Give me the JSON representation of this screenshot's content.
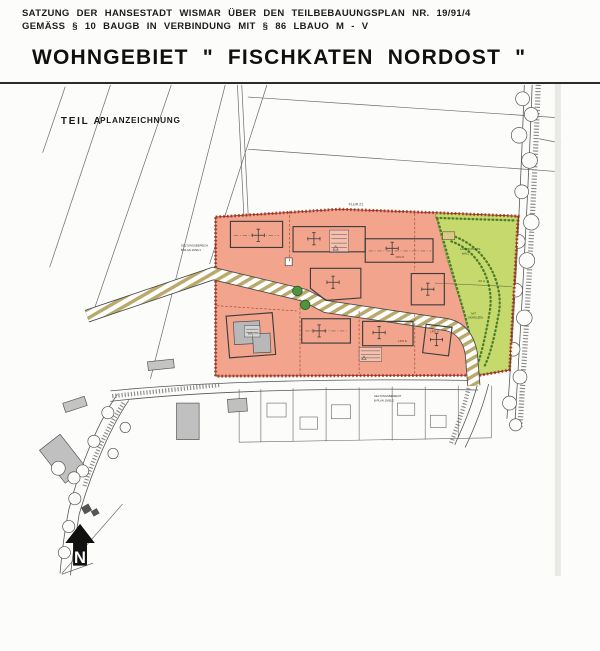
{
  "header": {
    "line1": "SATZUNG DER HANSESTADT WISMAR ÜBER DEN TEILBEBAUUNGSPLAN NR. 19/91/4",
    "line2": "GEMÄSS § 10 BAUGB IN VERBINDUNG MIT § 86 LBAUO M - V",
    "title": "WOHNGEBIET \" FISCHKATEN  NORDOST \""
  },
  "map": {
    "section": {
      "part": "TEIL A",
      "name": "PLANZEICHNUNG"
    },
    "labels": {
      "flur": "FLUR 21",
      "scope_west_line1": "GELTUNGSBEREICH",
      "scope_west_line2": "B-PLAN 19/91/1",
      "scope_south_line1": "GELTUNGSBEREICH",
      "scope_south_line2": "B-PLAN 19/91/2",
      "berm_line1": "LANDSCHAFTS-",
      "berm_line2": "WALL",
      "berm_height": "3,5 m",
      "green_line1": "MIT",
      "green_line2": "GEHÖLZEN",
      "lot_label_1": "LPG 5",
      "lot_label_2": "LPG 6.",
      "lot_label_3": "LPG 6",
      "plot_note": "WA"
    },
    "north_label": "N"
  },
  "colors": {
    "residential_fill": "#f2a48c",
    "residential_line": "#a84a32",
    "scope_boundary": "#a8321e",
    "green_fill": "#c5d96d",
    "green_line": "#4c7d2a",
    "road_stripe": "#b9a96a",
    "existing_building": "#c0c0c0",
    "ink": "#3a3a3a",
    "paper": "#fcfcfa"
  }
}
